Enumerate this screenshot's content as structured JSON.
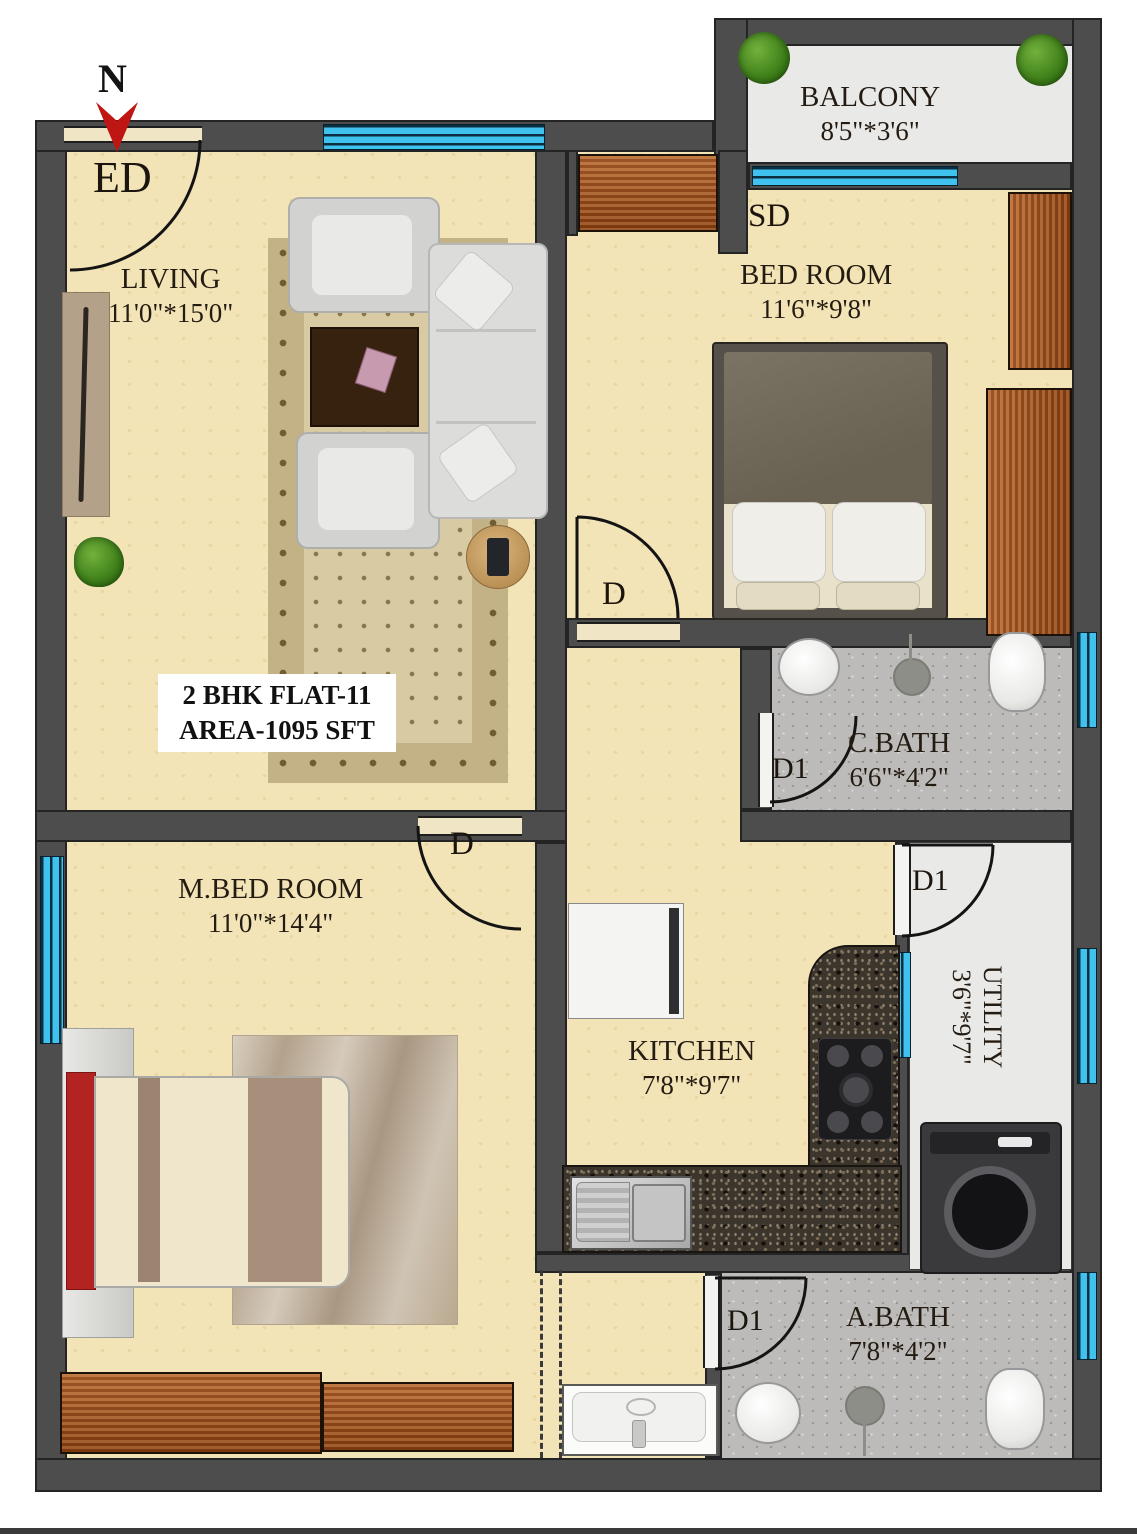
{
  "page": {
    "title_block": {
      "line1": "2 BHK FLAT-11",
      "line2": "AREA-1095 SFT"
    },
    "compass": {
      "north_label": "N"
    }
  },
  "rooms": {
    "living": {
      "name": "LIVING",
      "dims": "11'0\"*15'0\""
    },
    "balcony": {
      "name": "BALCONY",
      "dims": "8'5\"*3'6\""
    },
    "bedroom": {
      "name": "BED ROOM",
      "dims": "11'6\"*9'8\""
    },
    "cbath": {
      "name": "C.BATH",
      "dims": "6'6\"*4'2\""
    },
    "mbedroom": {
      "name": "M.BED ROOM",
      "dims": "11'0\"*14'4\""
    },
    "kitchen": {
      "name": "KITCHEN",
      "dims": "7'8\"*9'7\""
    },
    "utility": {
      "name": "UTILITY",
      "dims": "3'6\"*9'7\""
    },
    "abath": {
      "name": "A.BATH",
      "dims": "7'8\"*4'2\""
    }
  },
  "doors": {
    "entrance_label": "ED",
    "sliding_label": "SD",
    "bedroom_label": "D",
    "mbedroom_label": "D",
    "cbath_label": "D1",
    "utility_label": "D1",
    "abath_label": "D1"
  },
  "colors": {
    "wall": "#4d4d4d",
    "floor_cream": "#f2e4b6",
    "floor_bath": "#bcbbb9",
    "floor_light": "#e9e9e7",
    "window_blue": "#3fc3ee",
    "wood_brown": "#a0571f",
    "bed_red": "#b32322",
    "plant_green": "#4c8c22"
  }
}
